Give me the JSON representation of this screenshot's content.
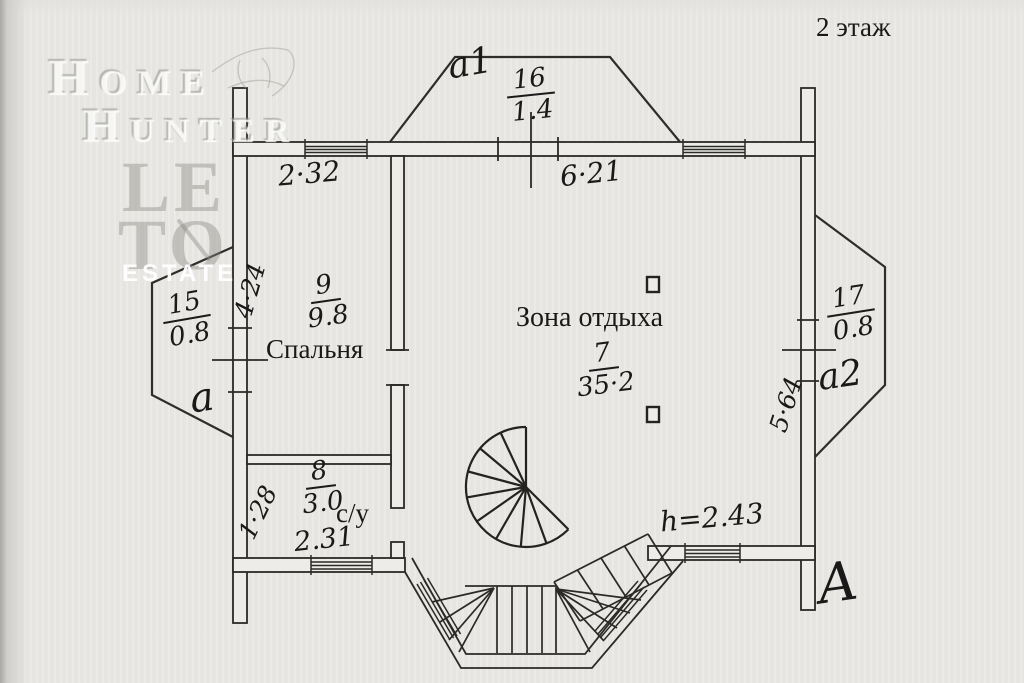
{
  "page": {
    "floor_label": "2 этаж"
  },
  "watermark": {
    "home": "Home",
    "hunter": "Hunter",
    "le": "LE",
    "to": "TO",
    "estate": "ESTATE"
  },
  "rooms": {
    "attic_top": {
      "letter": "a1",
      "number": "16",
      "area": "1.4"
    },
    "bay_left": {
      "letter": "a",
      "number": "15",
      "area": "0.8"
    },
    "bay_right": {
      "letter": "a2",
      "number": "17",
      "area": "0.8"
    },
    "bedroom": {
      "number": "9",
      "area": "9.8",
      "name": "Спальня"
    },
    "lounge": {
      "number": "7",
      "area": "35·2",
      "name": "Зона отдыха"
    },
    "bathroom": {
      "number": "8",
      "area": "3.0",
      "name": "с/у",
      "width": "2.31"
    }
  },
  "dimensions": {
    "top_left": "2·32",
    "top_right": "6·21",
    "left_wall": "4·24",
    "right_wall": "5·64",
    "bath_left": "1·28",
    "ceiling_height": "h=2.43"
  },
  "annotations": {
    "section_letter": "A"
  }
}
